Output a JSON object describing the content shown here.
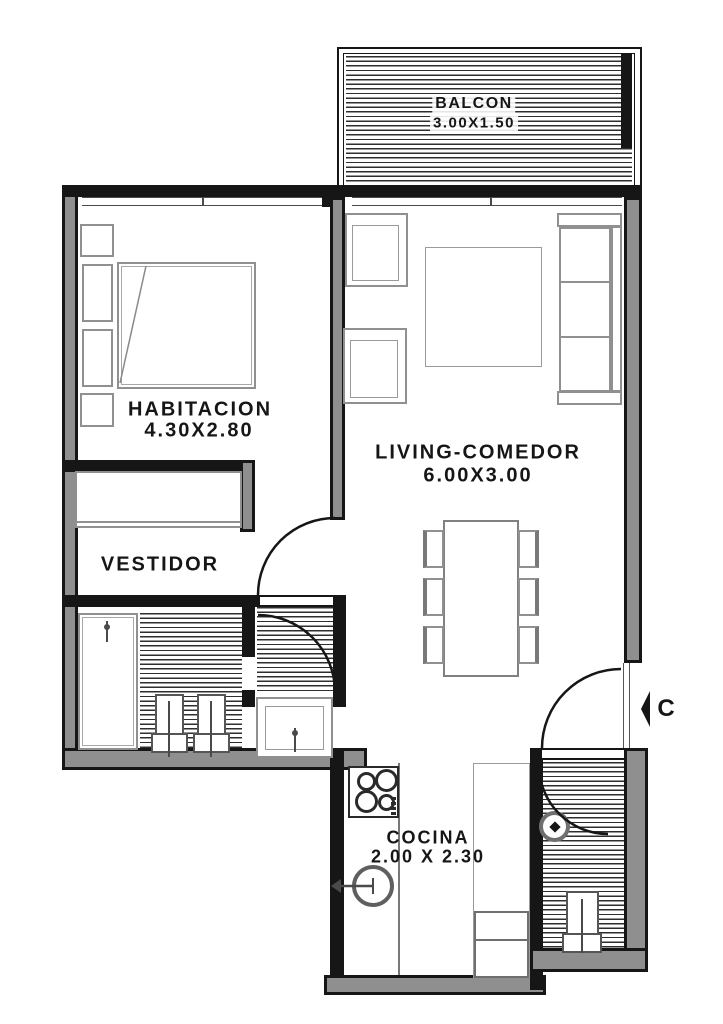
{
  "drawing": {
    "type": "apartment floor plan",
    "entrance": {
      "label": "C"
    },
    "rooms": {
      "balcon": {
        "name": "BALCON",
        "dims": "3.00X1.50"
      },
      "habitacion": {
        "name": "HABITACION",
        "dims": "4.30X2.80"
      },
      "living": {
        "name": "LIVING-COMEDOR",
        "dims": "6.00X3.00"
      },
      "vestidor": {
        "name": "VESTIDOR",
        "dims": ""
      },
      "cocina": {
        "name": "COCINA",
        "dims": "2.00 X 2.30"
      }
    },
    "fixtures": [
      "double-bed",
      "nightstands",
      "closet",
      "shower",
      "toilet",
      "bidet",
      "vanity-sink",
      "armchairs",
      "sofa",
      "rug",
      "dining-table-6-chairs",
      "cooktop",
      "kitchen-sink",
      "counter",
      "fridge",
      "washing-machine",
      "laundry-tub",
      "doors",
      "windows"
    ],
    "colors": {
      "wall": "#161616",
      "wall_core": "#8f8f8f",
      "furniture_line": "#909090",
      "hatch_line": "#2e2e2e"
    }
  }
}
